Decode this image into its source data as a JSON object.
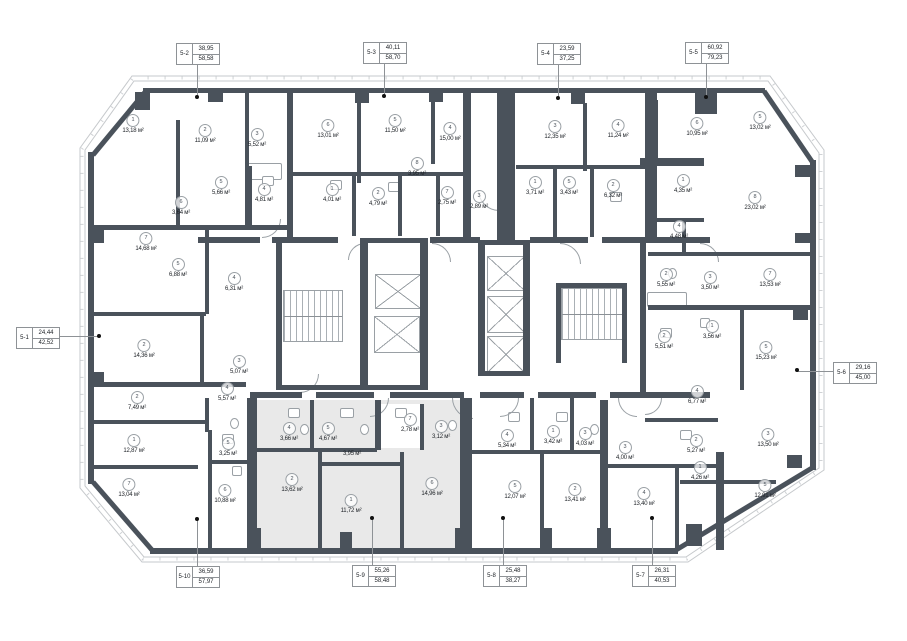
{
  "title": "Floor plan — residential level, units 5-1 to 5-10",
  "area_unit": "м²",
  "colors": {
    "wall": "#4a525b",
    "highlight": "#e9e9e9",
    "outline": "#c6c9cc",
    "label_line": "#8e9296",
    "text": "#1d2126"
  },
  "units": [
    {
      "id": "5-1",
      "value_top": "24,44",
      "value_bottom": "42,52",
      "box": {
        "x": 16,
        "y": 327
      },
      "dot": {
        "x": 99,
        "y": 336
      },
      "side": "left",
      "highlighted": false
    },
    {
      "id": "5-2",
      "value_top": "38,95",
      "value_bottom": "58,58",
      "box": {
        "x": 176,
        "y": 43
      },
      "dot": {
        "x": 197,
        "y": 97
      },
      "side": "top",
      "highlighted": false
    },
    {
      "id": "5-3",
      "value_top": "40,11",
      "value_bottom": "58,70",
      "box": {
        "x": 363,
        "y": 42
      },
      "dot": {
        "x": 384,
        "y": 96
      },
      "side": "top",
      "highlighted": false
    },
    {
      "id": "5-4",
      "value_top": "23,59",
      "value_bottom": "37,25",
      "box": {
        "x": 537,
        "y": 43
      },
      "dot": {
        "x": 558,
        "y": 98
      },
      "side": "top",
      "highlighted": false
    },
    {
      "id": "5-5",
      "value_top": "60,92",
      "value_bottom": "79,23",
      "box": {
        "x": 685,
        "y": 42
      },
      "dot": {
        "x": 706,
        "y": 97
      },
      "side": "top",
      "highlighted": false
    },
    {
      "id": "5-6",
      "value_top": "29,16",
      "value_bottom": "45,00",
      "box": {
        "x": 833,
        "y": 362
      },
      "dot": {
        "x": 797,
        "y": 370
      },
      "side": "right",
      "highlighted": false
    },
    {
      "id": "5-7",
      "value_top": "26,31",
      "value_bottom": "40,53",
      "box": {
        "x": 632,
        "y": 565
      },
      "dot": {
        "x": 652,
        "y": 518
      },
      "side": "bottom",
      "highlighted": false
    },
    {
      "id": "5-8",
      "value_top": "25,48",
      "value_bottom": "38,27",
      "box": {
        "x": 483,
        "y": 565
      },
      "dot": {
        "x": 503,
        "y": 518
      },
      "side": "bottom",
      "highlighted": false
    },
    {
      "id": "5-9",
      "value_top": "55,26",
      "value_bottom": "58,48",
      "box": {
        "x": 352,
        "y": 565
      },
      "dot": {
        "x": 372,
        "y": 518
      },
      "side": "bottom",
      "highlighted": true
    },
    {
      "id": "5-10",
      "value_top": "36,59",
      "value_bottom": "57,97",
      "box": {
        "x": 176,
        "y": 566
      },
      "dot": {
        "x": 197,
        "y": 519
      },
      "side": "bottom",
      "highlighted": false
    }
  ],
  "rooms": [
    {
      "n": "1",
      "area": "13,18",
      "x": 133,
      "y": 120
    },
    {
      "n": "2",
      "area": "11,09",
      "x": 205,
      "y": 130
    },
    {
      "n": "3",
      "area": "5,52",
      "x": 257,
      "y": 134
    },
    {
      "n": "5",
      "area": "5,66",
      "x": 221,
      "y": 182
    },
    {
      "n": "4",
      "area": "4,81",
      "x": 264,
      "y": 189
    },
    {
      "n": "6",
      "area": "3,64",
      "x": 181,
      "y": 202
    },
    {
      "n": "7",
      "area": "14,68",
      "x": 146,
      "y": 238
    },
    {
      "n": "5",
      "area": "6,88",
      "x": 178,
      "y": 264
    },
    {
      "n": "4",
      "area": "6,31",
      "x": 234,
      "y": 278
    },
    {
      "n": "2",
      "area": "14,36",
      "x": 144,
      "y": 345
    },
    {
      "n": "3",
      "area": "5,07",
      "x": 239,
      "y": 361
    },
    {
      "n": "4",
      "area": "5,57",
      "x": 227,
      "y": 388
    },
    {
      "n": "2",
      "area": "7,49",
      "x": 137,
      "y": 397
    },
    {
      "n": "1",
      "area": "12,87",
      "x": 134,
      "y": 440
    },
    {
      "n": "7",
      "area": "13,04",
      "x": 129,
      "y": 484
    },
    {
      "n": "5",
      "area": "3,25",
      "x": 228,
      "y": 443
    },
    {
      "n": "6",
      "area": "10,88",
      "x": 225,
      "y": 490
    },
    {
      "n": "6",
      "area": "13,01",
      "x": 328,
      "y": 125
    },
    {
      "n": "5",
      "area": "11,50",
      "x": 395,
      "y": 120
    },
    {
      "n": "4",
      "area": "15,00",
      "x": 450,
      "y": 128
    },
    {
      "n": "8",
      "area": "3,95",
      "x": 417,
      "y": 163
    },
    {
      "n": "1",
      "area": "4,01",
      "x": 332,
      "y": 189
    },
    {
      "n": "2",
      "area": "4,79",
      "x": 378,
      "y": 193
    },
    {
      "n": "7",
      "area": "2,75",
      "x": 447,
      "y": 192
    },
    {
      "n": "3",
      "area": "2,89",
      "x": 479,
      "y": 196
    },
    {
      "n": "3",
      "area": "12,35",
      "x": 555,
      "y": 126
    },
    {
      "n": "4",
      "area": "11,24",
      "x": 618,
      "y": 125
    },
    {
      "n": "1",
      "area": "3,71",
      "x": 535,
      "y": 182
    },
    {
      "n": "5",
      "area": "3,43",
      "x": 569,
      "y": 182
    },
    {
      "n": "2",
      "area": "6,32",
      "x": 613,
      "y": 185
    },
    {
      "n": "6",
      "area": "10,95",
      "x": 697,
      "y": 123
    },
    {
      "n": "5",
      "area": "13,02",
      "x": 760,
      "y": 117
    },
    {
      "n": "1",
      "area": "4,35",
      "x": 683,
      "y": 180
    },
    {
      "n": "8",
      "area": "23,02",
      "x": 755,
      "y": 197
    },
    {
      "n": "4",
      "area": "4,48",
      "x": 679,
      "y": 226
    },
    {
      "n": "2",
      "area": "5,55",
      "x": 666,
      "y": 274
    },
    {
      "n": "3",
      "area": "3,50",
      "x": 710,
      "y": 277
    },
    {
      "n": "7",
      "area": "13,53",
      "x": 770,
      "y": 274
    },
    {
      "n": "1",
      "area": "3,56",
      "x": 712,
      "y": 326
    },
    {
      "n": "2",
      "area": "5,51",
      "x": 664,
      "y": 336
    },
    {
      "n": "5",
      "area": "15,23",
      "x": 766,
      "y": 347
    },
    {
      "n": "4",
      "area": "6,77",
      "x": 697,
      "y": 391
    },
    {
      "n": "3",
      "area": "13,50",
      "x": 768,
      "y": 434
    },
    {
      "n": "3",
      "area": "4,00",
      "x": 625,
      "y": 447
    },
    {
      "n": "2",
      "area": "5,27",
      "x": 696,
      "y": 440
    },
    {
      "n": "1",
      "area": "4,26",
      "x": 700,
      "y": 467
    },
    {
      "n": "4",
      "area": "13,40",
      "x": 644,
      "y": 493
    },
    {
      "n": "5",
      "area": "12,91",
      "x": 765,
      "y": 485
    },
    {
      "n": "4",
      "area": "5,34",
      "x": 507,
      "y": 435
    },
    {
      "n": "1",
      "area": "3,42",
      "x": 553,
      "y": 431
    },
    {
      "n": "3",
      "area": "4,03",
      "x": 585,
      "y": 433
    },
    {
      "n": "5",
      "area": "12,07",
      "x": 515,
      "y": 486
    },
    {
      "n": "2",
      "area": "13,41",
      "x": 575,
      "y": 489
    },
    {
      "n": "4",
      "area": "3,66",
      "x": 289,
      "y": 428
    },
    {
      "n": "5",
      "area": "4,67",
      "x": 328,
      "y": 428
    },
    {
      "n": null,
      "area": "3,95",
      "x": 352,
      "y": 450
    },
    {
      "n": "7",
      "area": "2,78",
      "x": 410,
      "y": 419
    },
    {
      "n": "3",
      "area": "3,12",
      "x": 441,
      "y": 426
    },
    {
      "n": "2",
      "area": "13,62",
      "x": 292,
      "y": 479
    },
    {
      "n": "1",
      "area": "11,72",
      "x": 351,
      "y": 500
    },
    {
      "n": "6",
      "area": "14,96",
      "x": 432,
      "y": 483
    }
  ]
}
